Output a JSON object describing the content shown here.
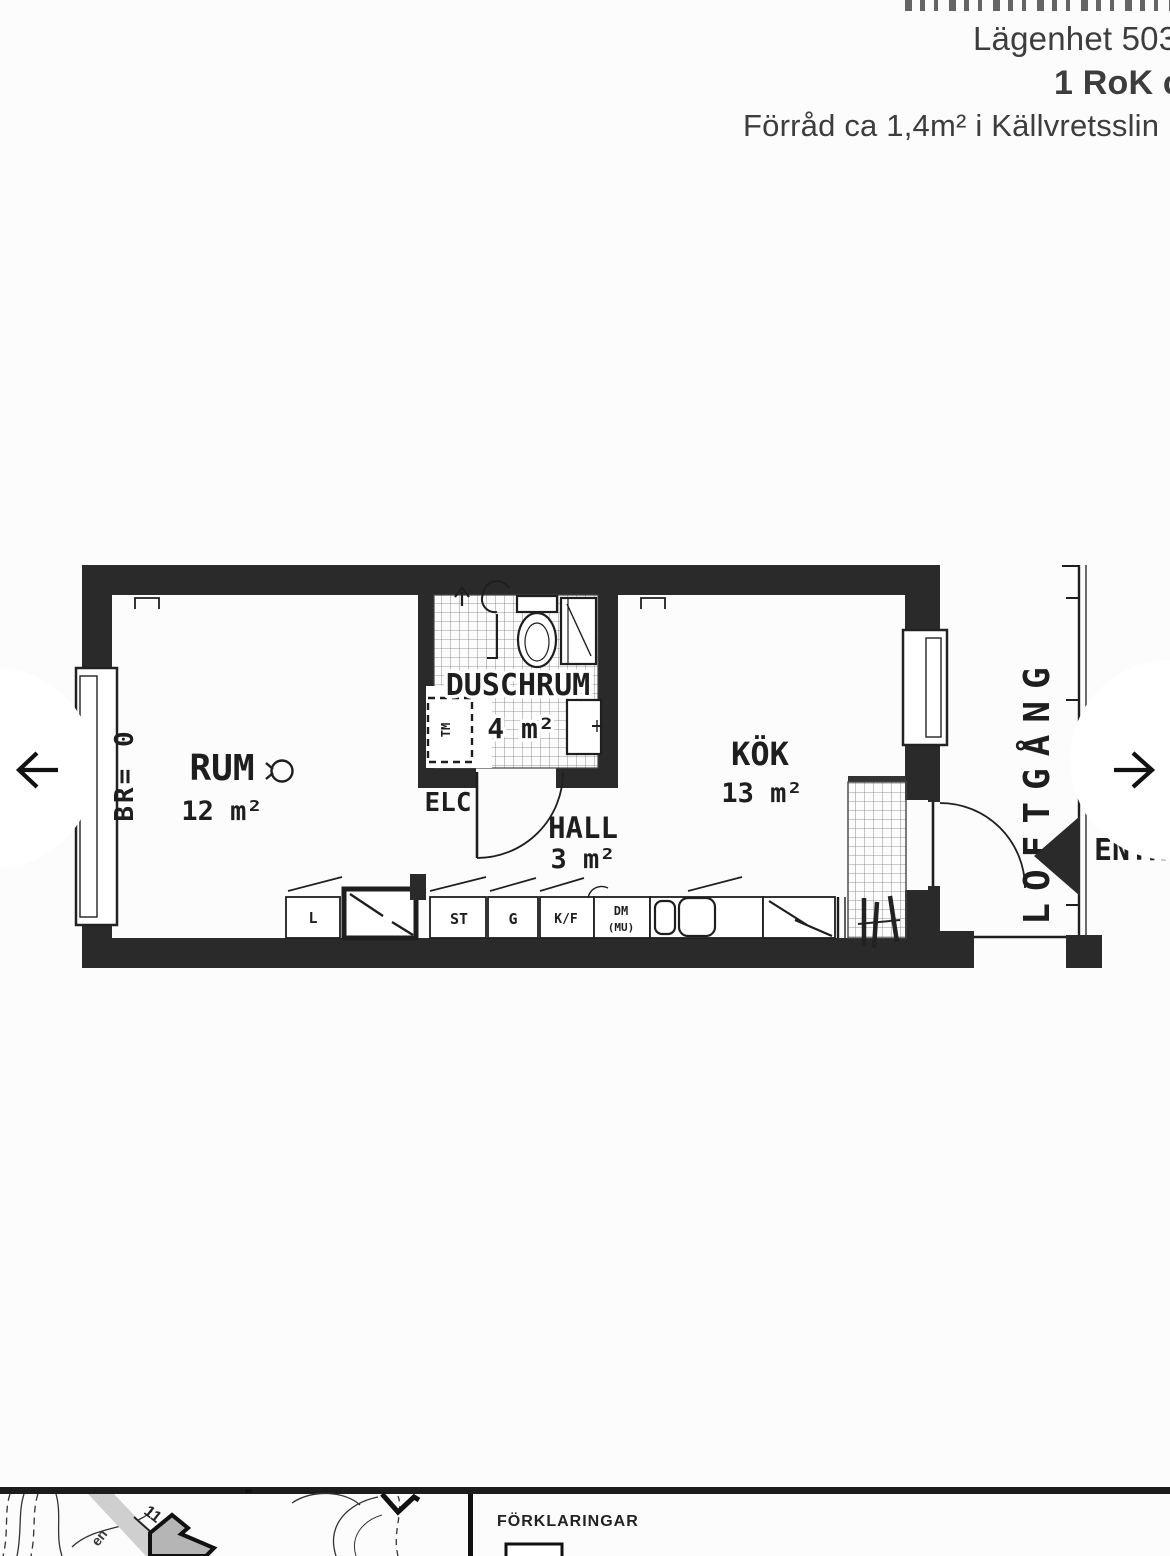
{
  "header": {
    "apartment_line": "Lägenhet 503",
    "rok_line": "1 RoK ca",
    "storage_line": "Förråd ca 1,4m² i Källvretsslin"
  },
  "plan": {
    "room_rum": {
      "name": "RUM",
      "area": "12 m²"
    },
    "room_dusch": {
      "name": "DUSCHRUM",
      "area": "4 m²"
    },
    "room_hall": {
      "name": "HALL",
      "area": "3 m²"
    },
    "room_kok": {
      "name": "KÖK",
      "area": "13 m²"
    },
    "br_label": "BR= 0",
    "elc_label": "ELC",
    "loftgang_label": "LOFTGÅNG",
    "entre_label": "ENTRÉ",
    "units": {
      "l": "L",
      "st": "ST",
      "g": "G",
      "kf": "K/F",
      "dm": "DM",
      "mu": "(MU)",
      "tm": "TM"
    }
  },
  "legend": {
    "title": "FÖRKLARINGAR"
  },
  "map": {
    "house_number": "11",
    "street_fragment": "en"
  }
}
